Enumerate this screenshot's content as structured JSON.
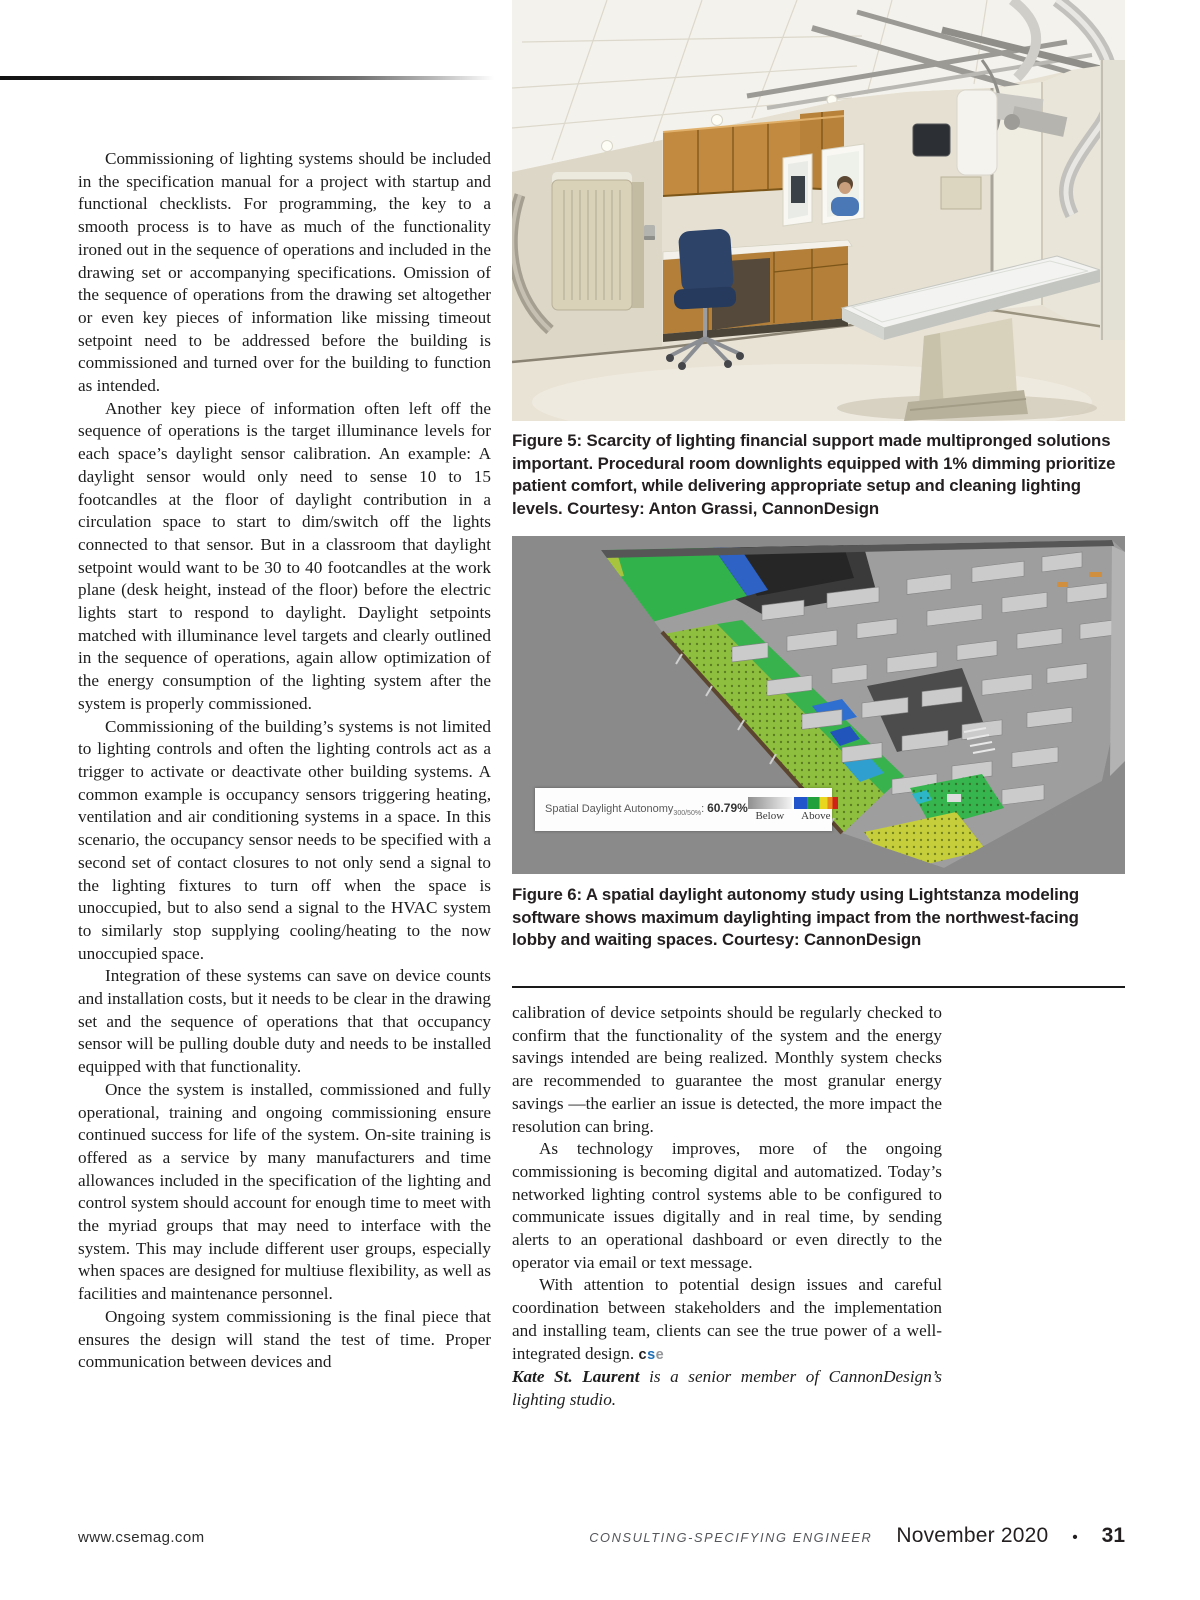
{
  "article": {
    "left_column": {
      "paragraphs": [
        "Commissioning of lighting systems should be included in the specification manual for a project with startup and functional checklists. For programming, the key to a smooth process is to have as much of the functionality ironed out in the sequence of operations and included in the drawing set or accompanying specifications. Omission of the sequence of operations from the drawing set altogether or even key pieces of information like missing timeout setpoint need to be addressed before the building is commissioned and turned over for the building to function as intended.",
        "Another key piece of information often left off the sequence of operations is the target illuminance levels for each space’s daylight sensor calibration. An example: A daylight sensor would only need to sense 10 to 15 footcandles at the floor of daylight contribution in a circulation space to start to dim/switch off the lights connected to that sensor. But in a classroom that daylight setpoint would want to be 30 to 40 footcandles at the work plane (desk height, instead of the floor) before the electric lights start to respond to daylight. Daylight setpoints matched with illuminance level targets and clearly outlined in the sequence of operations, again allow optimization of the energy consumption of the lighting system after the system is properly commissioned.",
        "Commissioning of the building’s systems is not limited to lighting controls and often the lighting controls act as a trigger to activate or deactivate other building systems. A common example is occupancy sensors triggering heating, ventilation and air conditioning systems in a space. In this scenario, the occupancy sensor needs to be specified with a second set of contact closures to not only send a signal to the lighting fixtures to turn off when the space is unoccupied, but to also send a signal to the HVAC system to similarly stop supplying cooling/heating to the now unoccupied space.",
        "Integration of these systems can save on device counts and installation costs, but it needs to be clear in the drawing set and the sequence of operations that that occupancy sensor will be pulling double duty and needs to be installed equipped with that functionality.",
        "Once the system is installed, commissioned and fully operational, training and ongoing commissioning ensure continued success for life of the system. On-site training is offered as a service by many manufacturers and time allowances included in the specification of the lighting and control system should account for enough time to meet with the myriad groups that may need to interface with the system. This may include different user groups, especially when spaces are designed for multiuse flexibility, as well as facilities and maintenance personnel.",
        "Ongoing system commissioning is the final piece that ensures the design will stand the test of time. Proper communication between devices and"
      ]
    },
    "right_column": {
      "paragraphs": [
        "calibration of device setpoints should be regularly checked to confirm that the functionality of the system and the energy savings intended are being realized. Monthly system checks are recommended to guarantee the most granular energy savings —the earlier an issue is detected, the more impact the resolution can bring.",
        "As technology improves, more of the ongoing commissioning is becoming digital and automatized. Today’s networked lighting control systems able to be configured to communicate issues digitally and in real time, by sending alerts to an operational dashboard or even directly to the operator via email or text message.",
        "With attention to potential design issues and careful coordination between stakeholders and the implementation and installing team, clients can see the true power of a well-integrated design."
      ],
      "end_mark_letters": [
        "c",
        "s",
        "e"
      ],
      "bio_name": "Kate St. Laurent",
      "bio_rest": " is a senior member of CannonDesign’s lighting studio."
    }
  },
  "figure5": {
    "caption": "Figure 5: Scarcity of lighting financial support made multipronged solutions important. Procedural room downlights equipped with 1% dimming prioritize patient comfort, while delivering appropriate setup and cleaning lighting levels. Courtesy: Anton Grassi, CannonDesign"
  },
  "figure6": {
    "caption": "Figure 6: A spatial daylight autonomy study using Lightstanza modeling software shows maximum daylighting impact from the northwest-facing lobby and waiting spaces. Courtesy: CannonDesign",
    "overlay": {
      "label": "Spatial Daylight Autonomy",
      "subscript": "300/50%",
      "separator": ":",
      "value": "60.79%",
      "legend_below": "Below",
      "legend_above": "Above"
    }
  },
  "footer": {
    "website": "www.csemag.com",
    "magazine": "CONSULTING-SPECIFYING ENGINEER",
    "issue": "November 2020",
    "bullet": "•",
    "page_number": "31"
  },
  "colors": {
    "end_mark_c": "#231f20",
    "end_mark_s": "#1f6fb5",
    "end_mark_e": "#939598",
    "sda_above_scale": [
      "#2255cc",
      "#22a03c",
      "#e8d61f",
      "#e88a1c",
      "#cf2318"
    ],
    "sda_below_scale": [
      "#8f8f8f",
      "#f4f4f4"
    ]
  }
}
